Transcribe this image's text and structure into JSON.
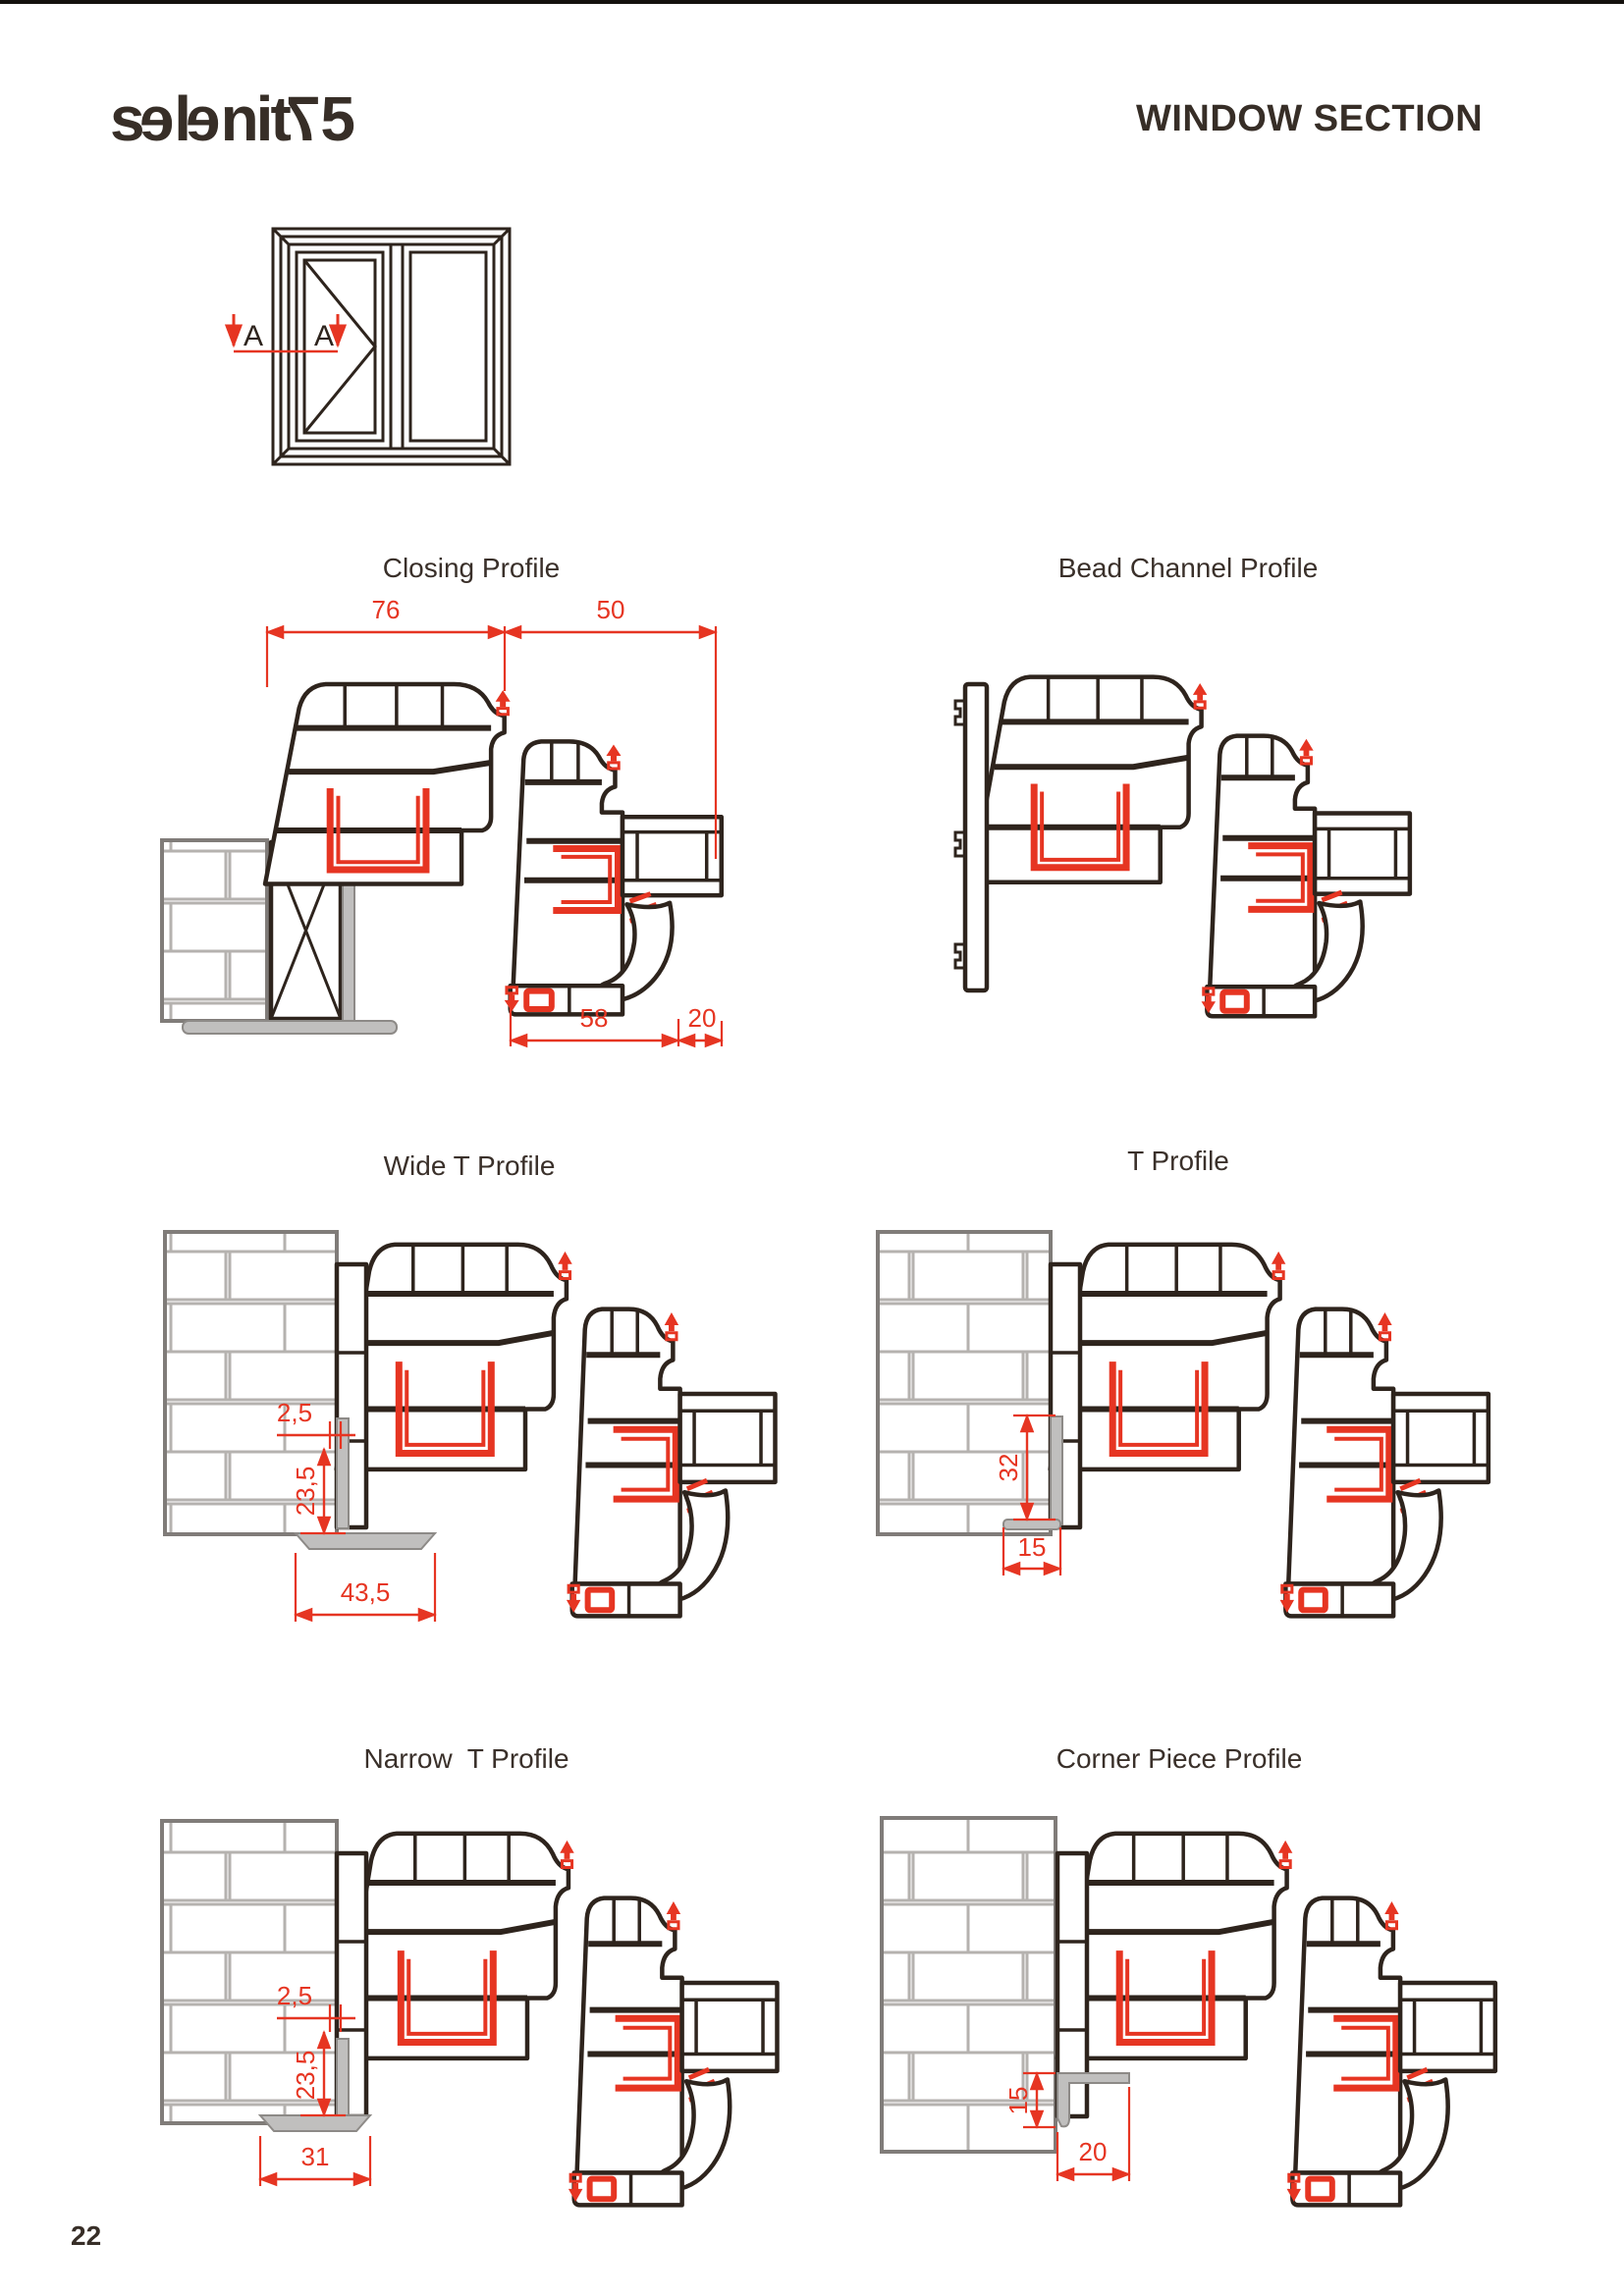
{
  "page": {
    "number": "22"
  },
  "header": {
    "logo_text": "selenit75",
    "logo_chars": [
      "s",
      "e",
      "l",
      "e",
      "n",
      "i",
      "t",
      "7",
      "5"
    ],
    "title": "WINDOW SECTION"
  },
  "section_marker": {
    "left": "A",
    "right": "A"
  },
  "panels": [
    {
      "id": "closing",
      "title": "Closing Profile",
      "dims": {
        "frame_width": "76",
        "sash_width": "50",
        "bottom_width": "58",
        "bead_width": "20"
      }
    },
    {
      "id": "bead-channel",
      "title": "Bead Channel Profile",
      "dims": {}
    },
    {
      "id": "wide-t",
      "title": "Wide T Profile",
      "dims": {
        "gap": "2,5",
        "depth": "23,5",
        "width": "43,5"
      }
    },
    {
      "id": "t",
      "title": "T Profile",
      "dims": {
        "height": "32",
        "width": "15"
      }
    },
    {
      "id": "narrow-t",
      "title": "Narrow  T Profile",
      "dims": {
        "gap": "2,5",
        "depth": "23,5",
        "width": "31"
      }
    },
    {
      "id": "corner",
      "title": "Corner Piece Profile",
      "dims": {
        "height": "15",
        "width": "20"
      }
    }
  ],
  "colors": {
    "ink": "#2e241d",
    "accent_red": "#e63522",
    "wall_gray": "#807c79",
    "part_gray": "#c0bfbe"
  }
}
